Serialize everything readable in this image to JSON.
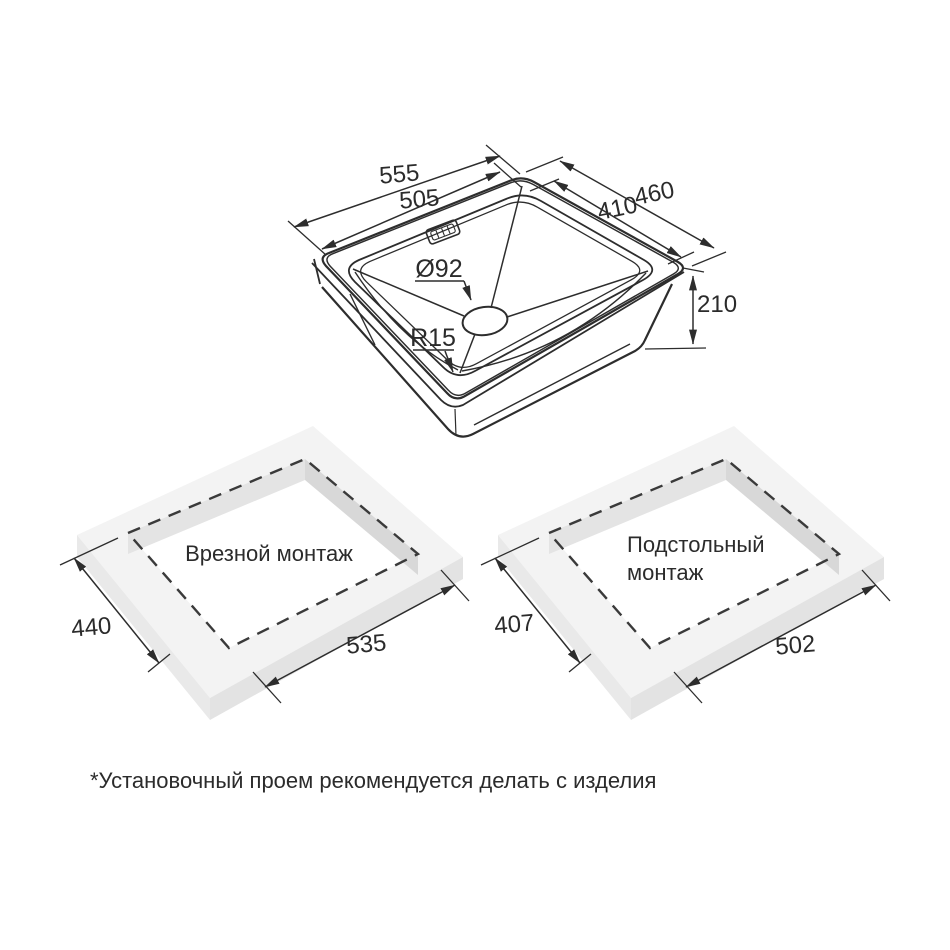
{
  "colors": {
    "line": "#2d2d2d",
    "text": "#2b2b2b",
    "slab_top": "#f3f3f3",
    "slab_side_left": "#e9e9e9",
    "slab_side_right": "#e3e3e3",
    "cutout_wall_left": "#e4e4e4",
    "cutout_wall_right": "#d8d8d8",
    "background": "#ffffff"
  },
  "sink": {
    "outer_width": "555",
    "inner_width": "505",
    "outer_depth": "460",
    "inner_depth": "410",
    "height": "210",
    "drain_diameter": "Ø92",
    "corner_radius": "R15"
  },
  "cutouts": {
    "inset": {
      "label": "Врезной монтаж",
      "depth": "440",
      "width": "535"
    },
    "undermount": {
      "label_line1": "Подстольный",
      "label_line2": "монтаж",
      "depth": "407",
      "width": "502"
    }
  },
  "footnote": "*Установочный проем рекомендуется делать с изделия"
}
